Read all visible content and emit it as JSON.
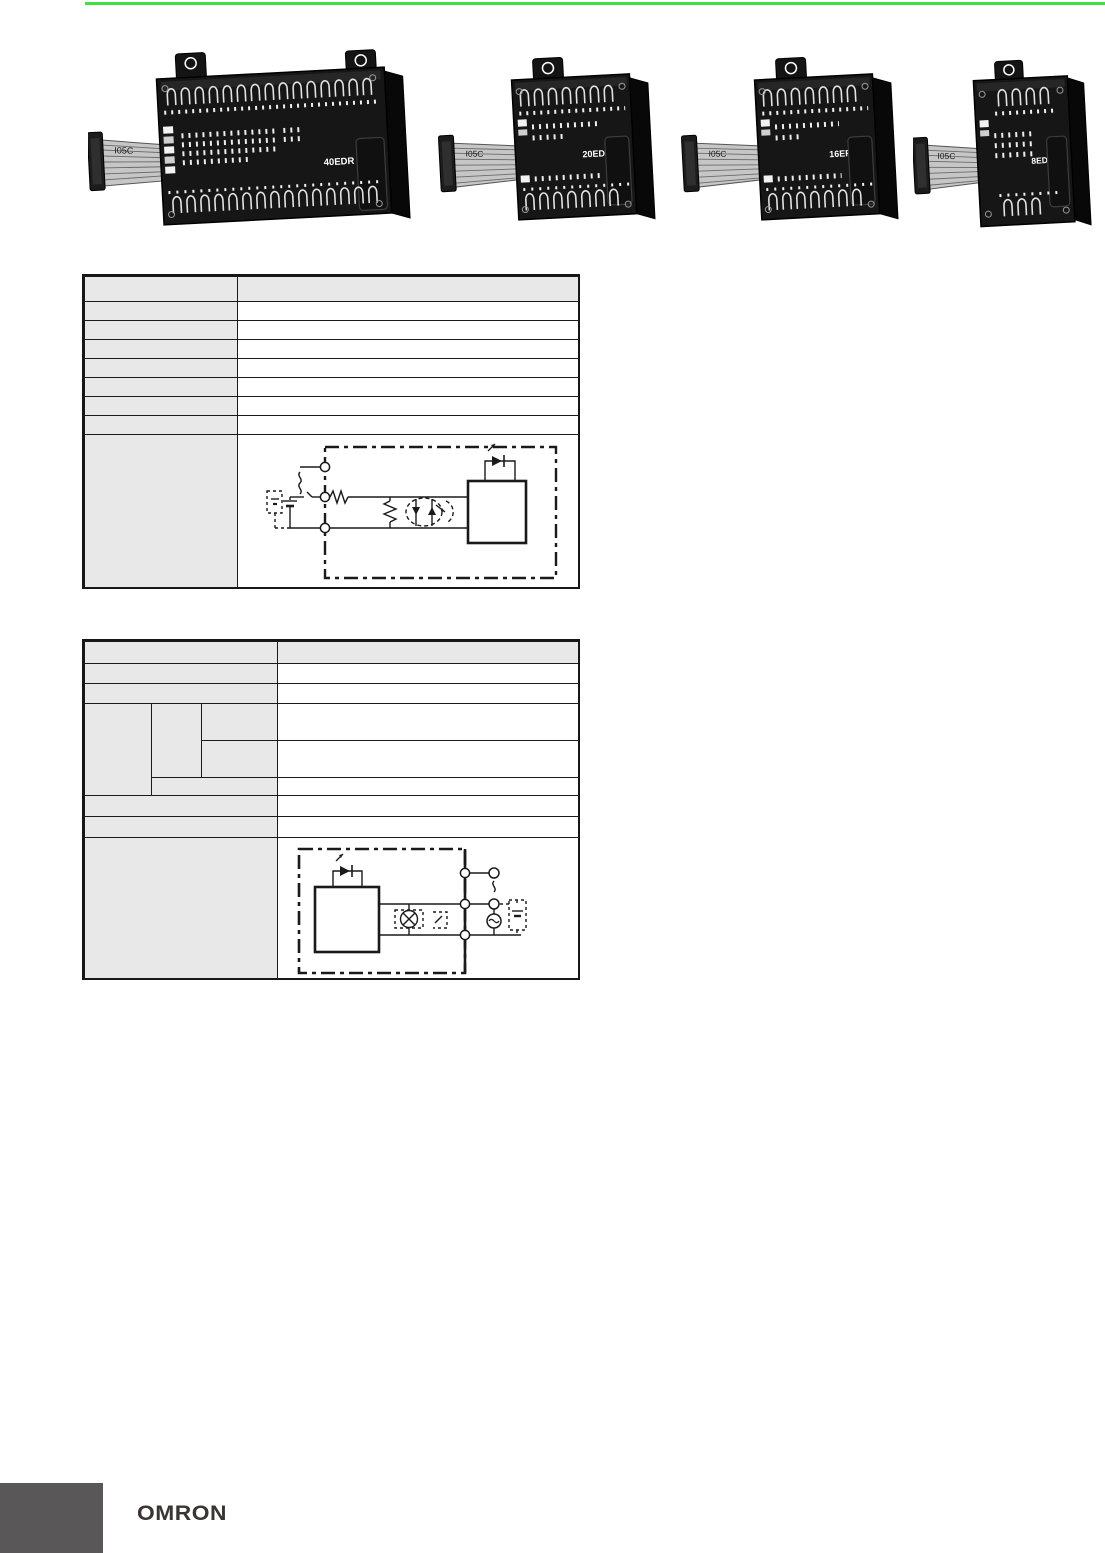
{
  "page": {
    "accent_color": "#3fdf3f",
    "footer_tab_color": "#595757",
    "table_header_fill": "#e8e8e8"
  },
  "units": [
    {
      "label": "40EDR",
      "cable": "I05C"
    },
    {
      "label": "20EDR1",
      "cable": "I05C"
    },
    {
      "label": "16ER",
      "cable": "I05C"
    },
    {
      "label": "8ED",
      "cable": "I05C"
    }
  ],
  "footer": {
    "logo": "OMRON"
  }
}
